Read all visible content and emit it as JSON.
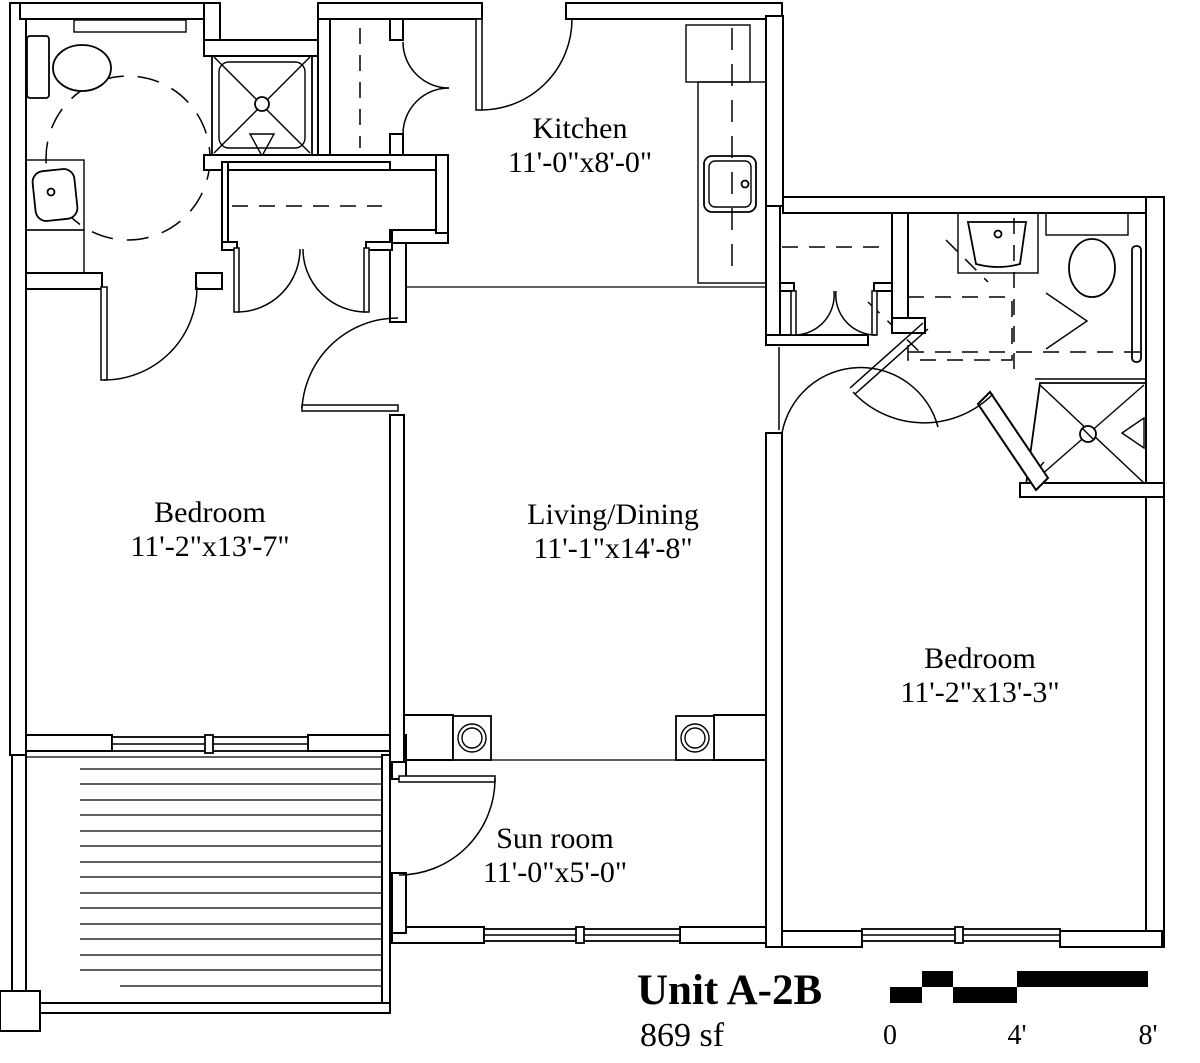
{
  "drawing": {
    "unit_label": "Unit A-2B",
    "area_label": "869 sf"
  },
  "rooms": {
    "kitchen": {
      "name": "Kitchen",
      "dims": "11'-0\"x8'-0\""
    },
    "bedroom_left": {
      "name": "Bedroom",
      "dims": "11'-2\"x13'-7\""
    },
    "living_dining": {
      "name": "Living/Dining",
      "dims": "11'-1\"x14'-8\""
    },
    "bedroom_right": {
      "name": "Bedroom",
      "dims": "11'-2\"x13'-3\""
    },
    "sun_room": {
      "name": "Sun room",
      "dims": "11'-0\"x5'-0\""
    }
  },
  "scale_bar": {
    "tick_0": "0",
    "tick_4": "4'",
    "tick_8": "8'"
  },
  "colors": {
    "line": "#000000",
    "background": "#ffffff",
    "scale_fill": "#000000"
  }
}
